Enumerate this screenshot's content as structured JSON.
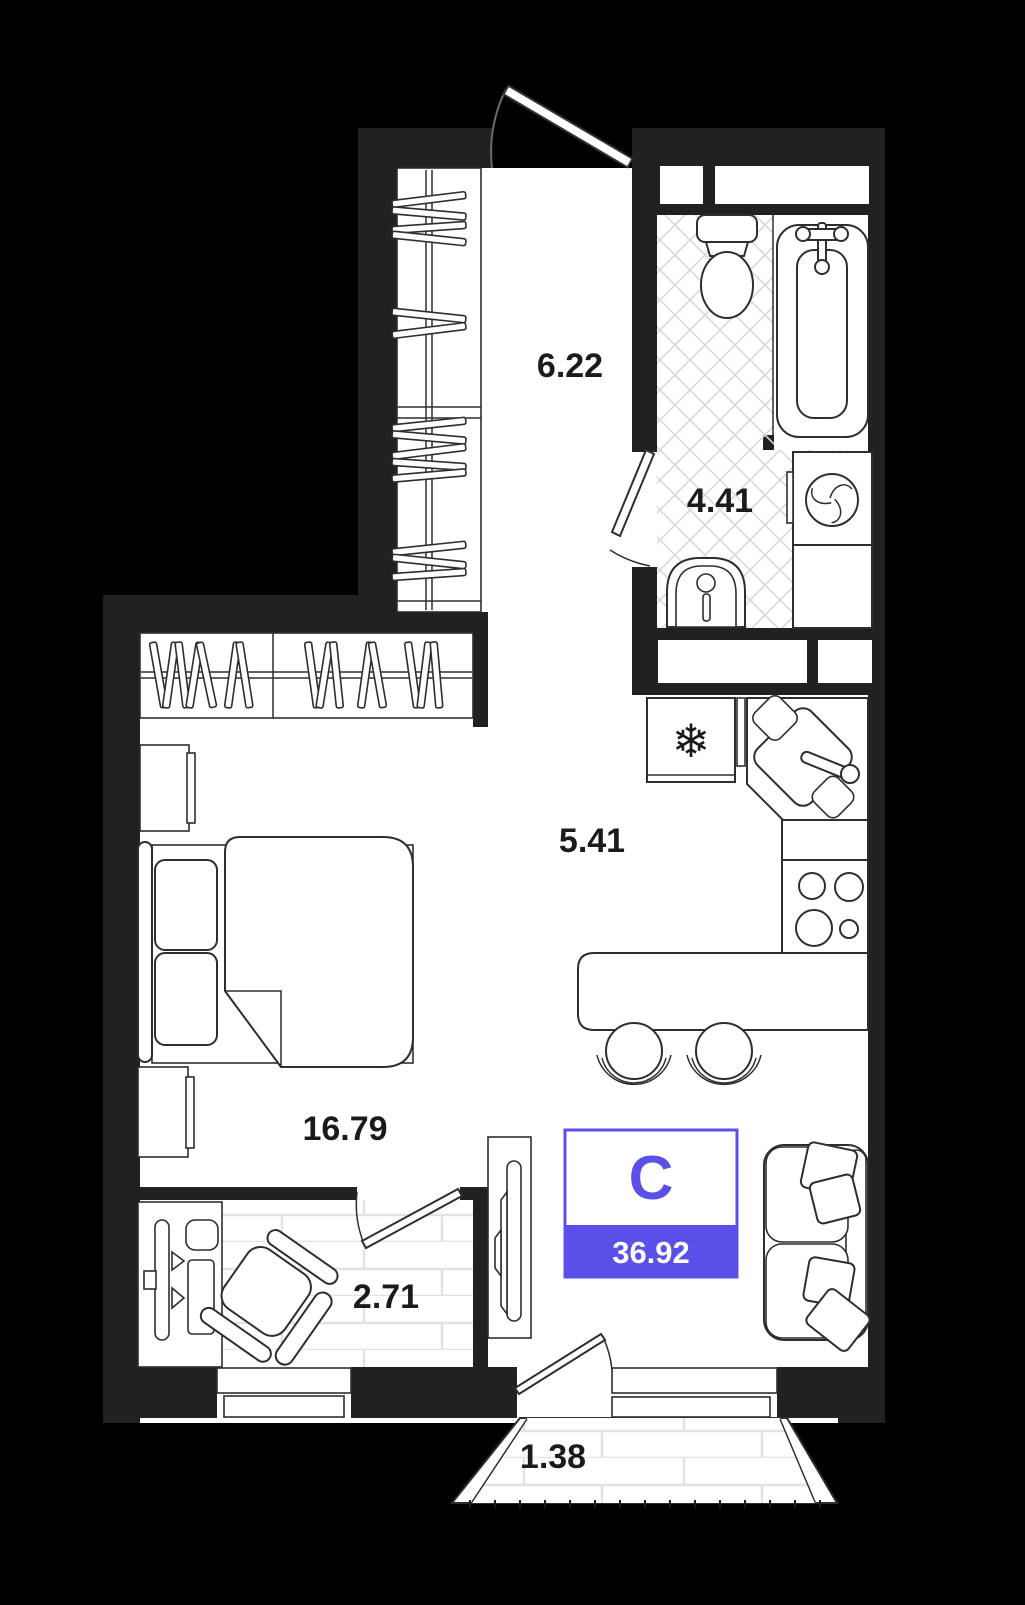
{
  "unit": {
    "type_label": "С",
    "total_area": "36.92"
  },
  "rooms": [
    {
      "id": "hallway",
      "area": "6.22"
    },
    {
      "id": "bathroom",
      "area": "4.41"
    },
    {
      "id": "kitchen-zone",
      "area": "5.41"
    },
    {
      "id": "living-bedroom",
      "area": "16.79"
    },
    {
      "id": "loggia-office",
      "area": "2.71"
    },
    {
      "id": "balcony",
      "area": "1.38"
    }
  ],
  "glyphs": {
    "snowflake": "❄"
  },
  "fixtures": [
    "entry-door",
    "hall-wardrobe",
    "living-wardrobe",
    "toilet",
    "bathtub",
    "bath-sink",
    "washing-machine",
    "refrigerator",
    "corner-kitchen-sink",
    "stove",
    "dining-table",
    "bar-stool",
    "sofa",
    "pillows",
    "bed",
    "nightstand",
    "desk",
    "monitor",
    "keyboard",
    "office-chair",
    "tv-stand",
    "window",
    "interior-door"
  ],
  "colors": {
    "background": "#000000",
    "wall": "#212121",
    "line": "#2e2e2e",
    "accent": "#5b4fe9",
    "floor_hatch": "#d9d9d9",
    "plank_line": "#e2e2e2",
    "label_text": "#1b1b1b"
  }
}
